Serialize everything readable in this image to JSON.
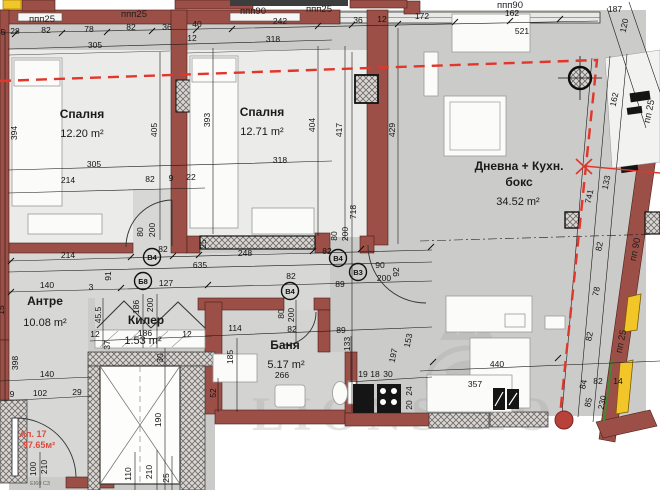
{
  "plan": {
    "apartment": {
      "label": "Ап. 17",
      "total_area": "97.65м²",
      "fire_rating": "EI60 C3"
    },
    "rooms": [
      {
        "name": "Спалня",
        "area": "12.20 m²"
      },
      {
        "name": "Спалня",
        "area": "12.71 m²"
      },
      {
        "name": "Дневна + Кухн. бокс",
        "area": "34.52 m²"
      },
      {
        "name": "Антре",
        "area": "10.08 m²"
      },
      {
        "name": "Килер",
        "area": "1.53 m²"
      },
      {
        "name": "Баня",
        "area": "5.17 m²"
      }
    ],
    "colors": {
      "wall": "#9c4f46",
      "window_frame": "#f2c629",
      "red_line": "#e2362b",
      "plan_bg": "#cbcbc9",
      "floor_light": "#ebebe9",
      "watermark": "#a5a5a0"
    },
    "watermark": {
      "text": "LIONS HO"
    },
    "markers": [
      {
        "t": "B4",
        "x": 152,
        "y": 257
      },
      {
        "t": "Б8",
        "x": 143,
        "y": 281
      },
      {
        "t": "B4",
        "x": 290,
        "y": 291
      },
      {
        "t": "B4",
        "x": 338,
        "y": 258
      },
      {
        "t": "B3",
        "x": 358,
        "y": 272
      }
    ],
    "texts": [
      {
        "t": "ппп25",
        "x": 42,
        "y": 22,
        "c": "wl"
      },
      {
        "t": "ппп25",
        "x": 134,
        "y": 17,
        "c": "wl"
      },
      {
        "t": "ппп90",
        "x": 253,
        "y": 14,
        "c": "wl"
      },
      {
        "t": "ппп25",
        "x": 319,
        "y": 12,
        "c": "wl"
      },
      {
        "t": "ппп90",
        "x": 510,
        "y": 8,
        "c": "wl"
      },
      {
        "t": "пп 25",
        "x": 652,
        "y": 112,
        "r": -78,
        "c": "wl"
      },
      {
        "t": "пп 90",
        "x": 638,
        "y": 250,
        "r": -78,
        "c": "wl"
      },
      {
        "t": "пп 25",
        "x": 624,
        "y": 342,
        "r": -78,
        "c": "wl"
      },
      {
        "t": "5",
        "x": 3,
        "y": 35,
        "c": "d"
      },
      {
        "t": "28",
        "x": 15,
        "y": 34,
        "c": "d"
      },
      {
        "t": "82",
        "x": 46,
        "y": 33,
        "c": "d"
      },
      {
        "t": "78",
        "x": 89,
        "y": 32,
        "c": "d"
      },
      {
        "t": "82",
        "x": 131,
        "y": 30,
        "c": "d"
      },
      {
        "t": "36",
        "x": 167,
        "y": 30,
        "c": "d"
      },
      {
        "t": "40",
        "x": 197,
        "y": 27,
        "c": "d"
      },
      {
        "t": "12",
        "x": 192,
        "y": 41,
        "c": "d"
      },
      {
        "t": "305",
        "x": 95,
        "y": 48,
        "c": "d"
      },
      {
        "t": "242",
        "x": 280,
        "y": 24,
        "c": "d"
      },
      {
        "t": "318",
        "x": 273,
        "y": 42,
        "c": "d"
      },
      {
        "t": "36",
        "x": 358,
        "y": 23,
        "c": "d"
      },
      {
        "t": "12",
        "x": 382,
        "y": 22,
        "c": "d"
      },
      {
        "t": "172",
        "x": 422,
        "y": 19,
        "c": "d"
      },
      {
        "t": "162",
        "x": 512,
        "y": 16,
        "c": "d"
      },
      {
        "t": "521",
        "x": 522,
        "y": 34,
        "c": "d"
      },
      {
        "t": "187",
        "x": 615,
        "y": 12,
        "c": "d"
      },
      {
        "t": "120",
        "x": 627,
        "y": 26,
        "r": -78,
        "c": "d"
      },
      {
        "t": "394",
        "x": 17,
        "y": 133,
        "r": -90,
        "c": "d"
      },
      {
        "t": "405",
        "x": 157,
        "y": 130,
        "r": -90,
        "c": "d"
      },
      {
        "t": "393",
        "x": 210,
        "y": 120,
        "r": -90,
        "c": "d"
      },
      {
        "t": "404",
        "x": 315,
        "y": 125,
        "r": -90,
        "c": "d"
      },
      {
        "t": "417",
        "x": 342,
        "y": 130,
        "r": -90,
        "c": "d"
      },
      {
        "t": "429",
        "x": 395,
        "y": 130,
        "r": -90,
        "c": "d"
      },
      {
        "t": "718",
        "x": 356,
        "y": 212,
        "r": -90,
        "c": "d"
      },
      {
        "t": "214",
        "x": 68,
        "y": 183,
        "c": "d"
      },
      {
        "t": "82",
        "x": 150,
        "y": 182,
        "c": "d"
      },
      {
        "t": "9",
        "x": 171,
        "y": 181,
        "c": "d"
      },
      {
        "t": "22",
        "x": 191,
        "y": 180,
        "c": "d"
      },
      {
        "t": "305",
        "x": 94,
        "y": 167,
        "c": "d"
      },
      {
        "t": "318",
        "x": 280,
        "y": 163,
        "c": "d"
      },
      {
        "t": "80",
        "x": 143,
        "y": 232,
        "r": -90,
        "c": "d"
      },
      {
        "t": "200",
        "x": 155,
        "y": 230,
        "r": -90,
        "c": "d"
      },
      {
        "t": "82",
        "x": 163,
        "y": 252,
        "c": "d"
      },
      {
        "t": "214",
        "x": 68,
        "y": 258,
        "c": "d"
      },
      {
        "t": "635",
        "x": 200,
        "y": 268,
        "c": "d"
      },
      {
        "t": "248",
        "x": 245,
        "y": 256,
        "c": "d"
      },
      {
        "t": "25",
        "x": 206,
        "y": 244,
        "r": -90,
        "c": "d"
      },
      {
        "t": "82",
        "x": 327,
        "y": 254,
        "c": "d"
      },
      {
        "t": "80",
        "x": 337,
        "y": 236,
        "r": -90,
        "c": "d"
      },
      {
        "t": "200",
        "x": 348,
        "y": 234,
        "r": -90,
        "c": "d"
      },
      {
        "t": "90",
        "x": 380,
        "y": 268,
        "c": "d"
      },
      {
        "t": "200",
        "x": 384,
        "y": 281,
        "c": "d"
      },
      {
        "t": "92",
        "x": 399,
        "y": 272,
        "r": -90,
        "c": "d"
      },
      {
        "t": "89",
        "x": 340,
        "y": 287,
        "c": "d"
      },
      {
        "t": "127",
        "x": 166,
        "y": 286,
        "c": "d"
      },
      {
        "t": "140",
        "x": 47,
        "y": 288,
        "c": "d"
      },
      {
        "t": "82",
        "x": 291,
        "y": 279,
        "c": "d"
      },
      {
        "t": "91",
        "x": 111,
        "y": 276,
        "r": -90,
        "c": "d"
      },
      {
        "t": "3",
        "x": 91,
        "y": 290,
        "c": "d"
      },
      {
        "t": "80",
        "x": 284,
        "y": 314,
        "r": -90,
        "c": "d"
      },
      {
        "t": "200",
        "x": 294,
        "y": 315,
        "r": -90,
        "c": "d"
      },
      {
        "t": "140",
        "x": 47,
        "y": 377,
        "c": "d"
      },
      {
        "t": "9",
        "x": 12,
        "y": 397,
        "c": "d"
      },
      {
        "t": "102",
        "x": 40,
        "y": 396,
        "c": "d"
      },
      {
        "t": "29",
        "x": 77,
        "y": 395,
        "c": "d"
      },
      {
        "t": "398",
        "x": 18,
        "y": 363,
        "r": -90,
        "c": "d"
      },
      {
        "t": "15",
        "x": 4,
        "y": 310,
        "r": -90,
        "c": "d"
      },
      {
        "t": "45.5",
        "x": 101,
        "y": 315,
        "r": -90,
        "c": "d"
      },
      {
        "t": "186",
        "x": 139,
        "y": 307,
        "r": -90,
        "c": "d"
      },
      {
        "t": "200",
        "x": 153,
        "y": 305,
        "r": -90,
        "c": "d"
      },
      {
        "t": "12",
        "x": 95,
        "y": 337,
        "c": "d"
      },
      {
        "t": "186",
        "x": 145,
        "y": 336,
        "c": "d"
      },
      {
        "t": "12",
        "x": 187,
        "y": 337,
        "c": "d"
      },
      {
        "t": "37",
        "x": 110,
        "y": 345,
        "r": -90,
        "c": "d"
      },
      {
        "t": "30",
        "x": 163,
        "y": 358,
        "r": -90,
        "c": "d"
      },
      {
        "t": "190",
        "x": 161,
        "y": 420,
        "r": -90,
        "c": "d"
      },
      {
        "t": "110",
        "x": 131,
        "y": 474,
        "r": -90,
        "c": "d"
      },
      {
        "t": "210",
        "x": 152,
        "y": 472,
        "r": -90,
        "c": "d"
      },
      {
        "t": "25",
        "x": 169,
        "y": 478,
        "r": -90,
        "c": "d"
      },
      {
        "t": "100",
        "x": 36,
        "y": 469,
        "r": -90,
        "c": "d"
      },
      {
        "t": "210",
        "x": 47,
        "y": 467,
        "r": -90,
        "c": "d"
      },
      {
        "t": "114",
        "x": 235,
        "y": 331,
        "c": "d"
      },
      {
        "t": "82",
        "x": 292,
        "y": 332,
        "c": "d"
      },
      {
        "t": "89",
        "x": 341,
        "y": 333,
        "c": "d"
      },
      {
        "t": "185",
        "x": 233,
        "y": 357,
        "r": -90,
        "c": "d"
      },
      {
        "t": "133",
        "x": 350,
        "y": 344,
        "r": -90,
        "c": "d"
      },
      {
        "t": "153",
        "x": 411,
        "y": 341,
        "r": -78,
        "c": "d"
      },
      {
        "t": "197",
        "x": 396,
        "y": 356,
        "r": -78,
        "c": "d"
      },
      {
        "t": "266",
        "x": 282,
        "y": 378,
        "c": "d"
      },
      {
        "t": "52",
        "x": 216,
        "y": 393,
        "r": -90,
        "c": "d"
      },
      {
        "t": "19",
        "x": 363,
        "y": 377,
        "c": "d"
      },
      {
        "t": "18",
        "x": 375,
        "y": 377,
        "c": "d"
      },
      {
        "t": "30",
        "x": 388,
        "y": 377,
        "c": "d"
      },
      {
        "t": "24",
        "x": 412,
        "y": 391,
        "r": -90,
        "c": "d"
      },
      {
        "t": "20",
        "x": 412,
        "y": 405,
        "r": -90,
        "c": "d"
      },
      {
        "t": "440",
        "x": 497,
        "y": 367,
        "c": "d"
      },
      {
        "t": "357",
        "x": 475,
        "y": 387,
        "c": "d"
      },
      {
        "t": "162",
        "x": 617,
        "y": 100,
        "r": -78,
        "c": "d"
      },
      {
        "t": "133",
        "x": 609,
        "y": 183,
        "r": -78,
        "c": "d"
      },
      {
        "t": "741",
        "x": 592,
        "y": 197,
        "r": -78,
        "c": "d"
      },
      {
        "t": "82",
        "x": 602,
        "y": 247,
        "r": -78,
        "c": "d"
      },
      {
        "t": "78",
        "x": 599,
        "y": 292,
        "r": -78,
        "c": "d"
      },
      {
        "t": "82",
        "x": 592,
        "y": 337,
        "r": -78,
        "c": "d"
      },
      {
        "t": "84",
        "x": 586,
        "y": 385,
        "r": -78,
        "c": "d"
      },
      {
        "t": "82",
        "x": 598,
        "y": 384,
        "c": "d"
      },
      {
        "t": "14",
        "x": 618,
        "y": 384,
        "c": "d"
      },
      {
        "t": "85",
        "x": 591,
        "y": 403,
        "r": -78,
        "c": "d"
      },
      {
        "t": "230",
        "x": 605,
        "y": 403,
        "r": -78,
        "c": "d"
      },
      {
        "t": "Спалня",
        "x": 82,
        "y": 118,
        "c": "room"
      },
      {
        "t": "12.20 m²",
        "x": 82,
        "y": 137,
        "c": "area"
      },
      {
        "t": "Спалня",
        "x": 262,
        "y": 116,
        "c": "room"
      },
      {
        "t": "12.71 m²",
        "x": 262,
        "y": 135,
        "c": "area"
      },
      {
        "t": "Дневна + Кухн.",
        "x": 519,
        "y": 170,
        "c": "room"
      },
      {
        "t": "бокс",
        "x": 519,
        "y": 186,
        "c": "room"
      },
      {
        "t": "34.52 m²",
        "x": 518,
        "y": 205,
        "c": "area"
      },
      {
        "t": "Антре",
        "x": 45,
        "y": 305,
        "c": "room"
      },
      {
        "t": "10.08 m²",
        "x": 45,
        "y": 326,
        "c": "area"
      },
      {
        "t": "Килер",
        "x": 146,
        "y": 324,
        "c": "room"
      },
      {
        "t": "1.53 m²",
        "x": 143,
        "y": 344,
        "c": "area"
      },
      {
        "t": "Баня",
        "x": 285,
        "y": 349,
        "c": "room"
      },
      {
        "t": "5.17 m²",
        "x": 286,
        "y": 368,
        "c": "area"
      },
      {
        "t": "Ап. 17",
        "x": 33,
        "y": 437,
        "c": "red"
      },
      {
        "t": "97.65м²",
        "x": 39,
        "y": 448,
        "c": "red"
      },
      {
        "t": "EI60 C3",
        "x": 40,
        "y": 485,
        "c": "tiny"
      }
    ]
  }
}
